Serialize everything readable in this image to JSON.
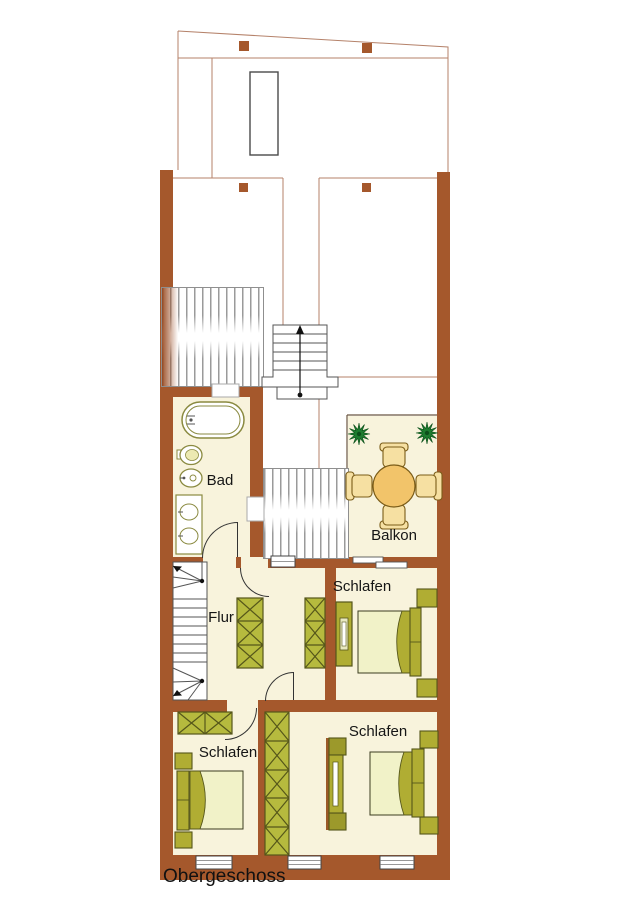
{
  "floor_label": "Obergeschoss",
  "rooms": [
    {
      "id": "bad",
      "label": "Bad"
    },
    {
      "id": "balkon",
      "label": "Balkon"
    },
    {
      "id": "schlafen-oben",
      "label": "Schlafen"
    },
    {
      "id": "flur",
      "label": "Flur"
    },
    {
      "id": "schlafen-unten-links",
      "label": "Schlafen"
    },
    {
      "id": "schlafen-unten-rechts",
      "label": "Schlafen"
    }
  ],
  "colors": {
    "wall": "#a5582c",
    "roof_outline": "#b5826a",
    "floor": "#f8f3dc",
    "wardrobe": "#b6ba3e",
    "furniture_dark": "#55561a",
    "bed_frame": "#b0ad33",
    "bed_cover": "#f1f2c8",
    "table": "#f2c46a",
    "chair": "#f6e0a2",
    "plant": "#1e7d2f"
  },
  "icons": {
    "bathtub": "stadium-outline",
    "toilet": "oval",
    "bidet": "oval",
    "double-sink": "rect-two-ovals",
    "round-table": "circle",
    "chairs": "rounded-rects",
    "plants": "star-burst",
    "beds": "rect-with-headboard",
    "wardrobes": "x-pattern-rects",
    "stairs": "treads-with-arrow",
    "windows": "triple-line-rect"
  }
}
